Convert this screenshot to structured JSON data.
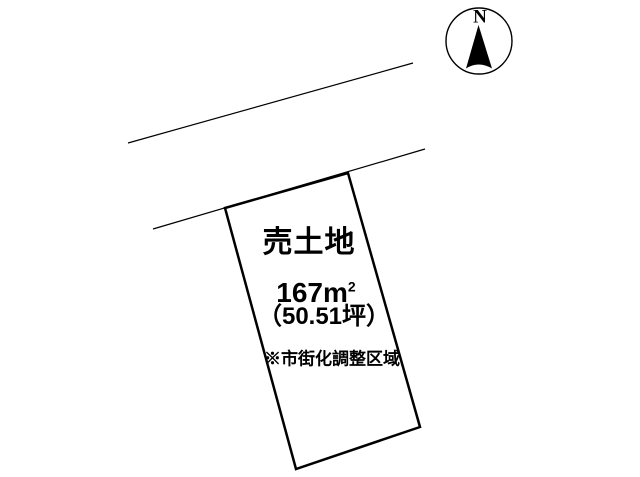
{
  "diagram": {
    "title": "売土地",
    "area_sqm_value": "167m",
    "area_sqm_exponent": "2",
    "area_tsubo": "（50.51坪）",
    "zoning_note": "※市街化調整区域"
  },
  "compass": {
    "north_label": "N"
  },
  "colors": {
    "line": "#000000",
    "background": "#ffffff"
  }
}
